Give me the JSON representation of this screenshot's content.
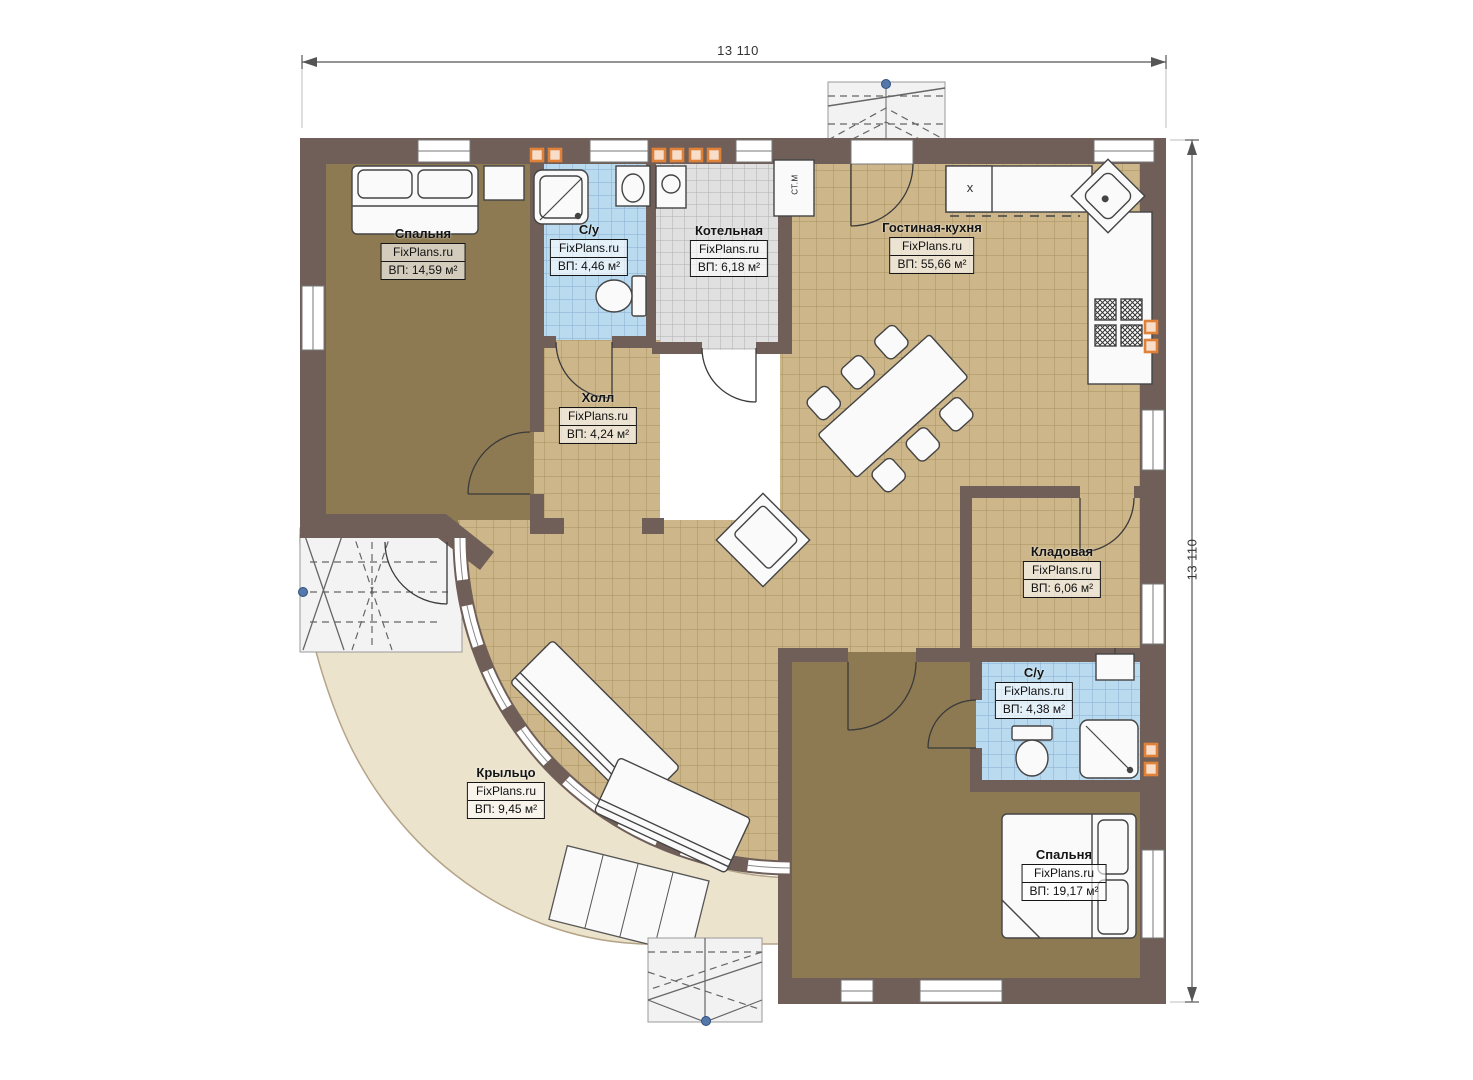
{
  "palette": {
    "wall": "#6f5f58",
    "floor_wood": "#8d7a52",
    "tile_tan": "#cdb68a",
    "tile_blue": "#badbef",
    "tile_gray": "#e0e0e0",
    "porch": "#ece3cd",
    "vent_orange": "#e0813a",
    "roof_gray": "#f2f2f2",
    "node_blue": "#5577aa"
  },
  "dimensions": {
    "top": "13 110",
    "right": "13 110"
  },
  "rooms": [
    {
      "name": "Спальня",
      "brand": "FixPlans.ru",
      "area": "ВП: 14,59 м²"
    },
    {
      "name": "С/у",
      "brand": "FixPlans.ru",
      "area": "ВП: 4,46 м²"
    },
    {
      "name": "Котельная",
      "brand": "FixPlans.ru",
      "area": "ВП: 6,18 м²"
    },
    {
      "name": "Гостиная-кухня",
      "brand": "FixPlans.ru",
      "area": "ВП: 55,66 м²"
    },
    {
      "name": "Холл",
      "brand": "FixPlans.ru",
      "area": "ВП: 4,24 м²"
    },
    {
      "name": "Кладовая",
      "brand": "FixPlans.ru",
      "area": "ВП: 6,06 м²"
    },
    {
      "name": "С/у",
      "brand": "FixPlans.ru",
      "area": "ВП: 4,38 м²"
    },
    {
      "name": "Спальня",
      "brand": "FixPlans.ru",
      "area": "ВП: 19,17 м²"
    },
    {
      "name": "Крыльцо",
      "brand": "FixPlans.ru",
      "area": "ВП: 9,45 м²"
    }
  ],
  "annotations": {
    "washing_machine": "СТ.М",
    "stove_mark": "x"
  }
}
